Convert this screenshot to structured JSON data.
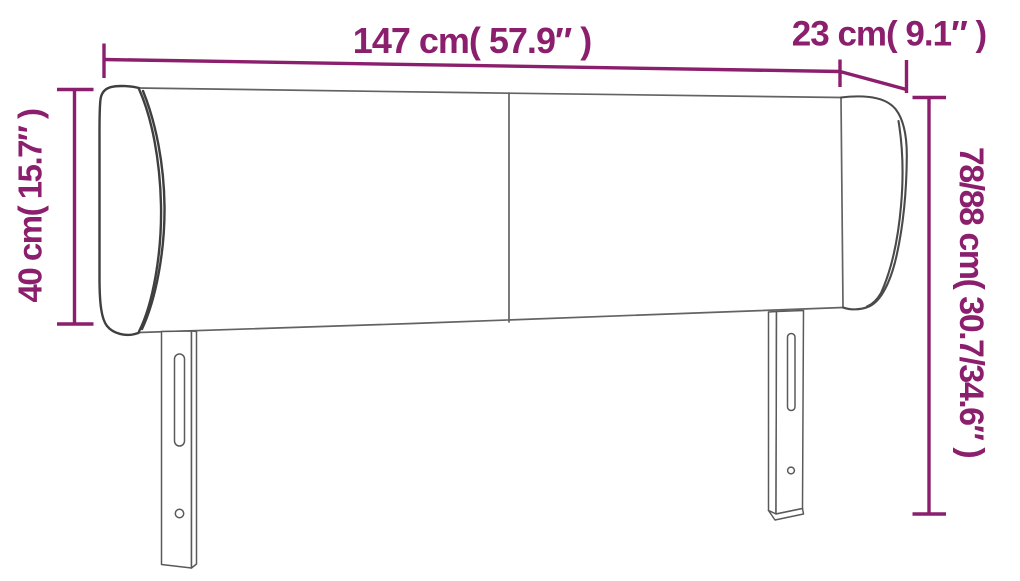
{
  "diagram": {
    "type": "product-dimension-drawing",
    "subject": "headboard",
    "labels": {
      "width": "147 cm( 57.9″ )",
      "depth": "23 cm( 9.1″ )",
      "wing_height": "40 cm( 15.7″ )",
      "total_height": "78/88 cm( 30.7/34.6″ )"
    },
    "colors": {
      "dimension": "#8b1e6d",
      "outline_dark": "#3f3f3f",
      "outline_mid": "#636363",
      "background": "#ffffff"
    }
  }
}
